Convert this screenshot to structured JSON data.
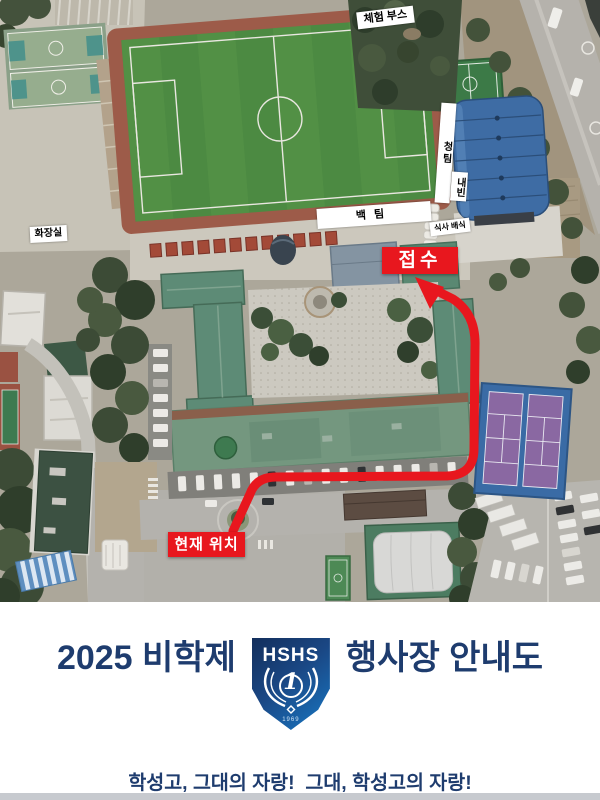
{
  "map": {
    "labels": {
      "experience_booth": "체험 부스",
      "blue_team": "청팀",
      "guests": "내빈",
      "white_team": "백팀",
      "meal_service": "식사 배식",
      "restroom": "화장실",
      "reception": "접수",
      "current_location": "현재 위치"
    },
    "colors": {
      "route_red": "#e8171e",
      "label_bg": "#ffffff",
      "field_green": "#4c8a42",
      "track_red": "#9d5b49",
      "gym_roof_blue": "#3e6ca4",
      "tennis_purple": "#8a68a2",
      "tennis_apron_blue": "#3a6ba5"
    }
  },
  "footer": {
    "title_left": "2025 비학제",
    "title_right": "행사장 안내도",
    "slogan": "학성고, 그대의 자랑!  그대, 학성고의 자랑!",
    "logo": {
      "school_initials": "HSHS",
      "number": "1",
      "year": "1969"
    },
    "colors": {
      "title_navy": "#1e3c6e",
      "shield_dark": "#132f5c",
      "shield_light": "#1878c4"
    }
  }
}
